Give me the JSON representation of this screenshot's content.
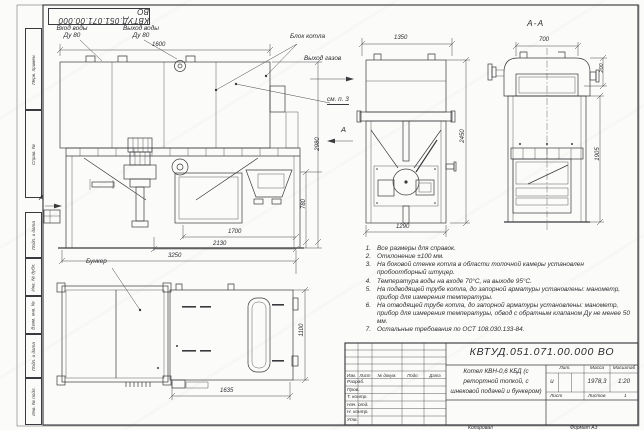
{
  "sheet": {
    "stamp_top_mirrored": "КВТУД.051.071.00.000 ВО",
    "left_columns": [
      "Перв. примен.",
      "Справ. №",
      "Подп. и дата",
      "Инв. № дубл.",
      "Взам. инв. №",
      "Подп. и дата",
      "Инв. № подл."
    ],
    "copied_label": "Копировал",
    "format_label": "Формат А3"
  },
  "labels": {
    "water_in_l1": "Вход воды",
    "water_in_l2": "Ду 80",
    "water_out_l1": "Выход воды",
    "water_out_l2": "Ду 80",
    "boiler_block": "Блок котла",
    "gas_out": "Выход газов",
    "see_note": "см. п. 3",
    "bunker": "Бункер",
    "section_title": "А-А",
    "arrow_a": "А"
  },
  "dims": {
    "w1600": "1600",
    "h2980": "2980",
    "h780": "780",
    "l1700": "1700",
    "l2130": "2130",
    "l3250": "3250",
    "w1350": "1350",
    "h2450": "2450",
    "w1290": "1290",
    "w700": "700",
    "h200": "200",
    "h1905": "1905",
    "l1635": "1635",
    "w1100": "1100"
  },
  "notes": {
    "items": [
      {
        "num": "1.",
        "text": "Все размеры для справок."
      },
      {
        "num": "2.",
        "text": "Отклонение ±100 мм."
      },
      {
        "num": "3.",
        "text": "На боковой стенке котла в области топочной камеры установлен пробоотборный штуцер."
      },
      {
        "num": "4.",
        "text": "Температура воды на входе 70°С, на выходе 95°С."
      },
      {
        "num": "5.",
        "text": "На подводящей трубе котла, до запорной арматуры установлены: манометр, прибор для измерения температуры."
      },
      {
        "num": "6.",
        "text": "На отводящей трубе котла, до запорной арматуры установлены: манометр, прибор для измерения температуры, обвод с обратным клапаном Ду не менее 50 мм."
      },
      {
        "num": "7.",
        "text": "Остальные требования по ОСТ 108.030.133-84."
      }
    ]
  },
  "title_block": {
    "designation": "КВТУД.051.071.00.000 ВО",
    "name_l1": "Котел КВН-0,6 КБД (с",
    "name_l2": "ретортной топкой, с",
    "name_l3": "шнековой подачей и бункером)",
    "col_izm": "Изм.",
    "col_list": "Лист",
    "col_doc": "№ докум.",
    "col_podp": "Подп.",
    "col_data": "Дата",
    "row_razrab": "Разраб.",
    "row_prov": "Пров.",
    "row_tkontr": "Т. контр.",
    "row_nachotd": "Нач. отд.",
    "row_nkontr": "Н. контр.",
    "row_utv": "Утв.",
    "lit_label": "Лит.",
    "lit_value": "и",
    "mass_label": "Масса",
    "mass_value": "1978,3",
    "scale_label": "Масштаб",
    "scale_value": "1:20",
    "sheet_label": "Лист",
    "sheets_label": "Листов",
    "sheets_value": "1"
  }
}
